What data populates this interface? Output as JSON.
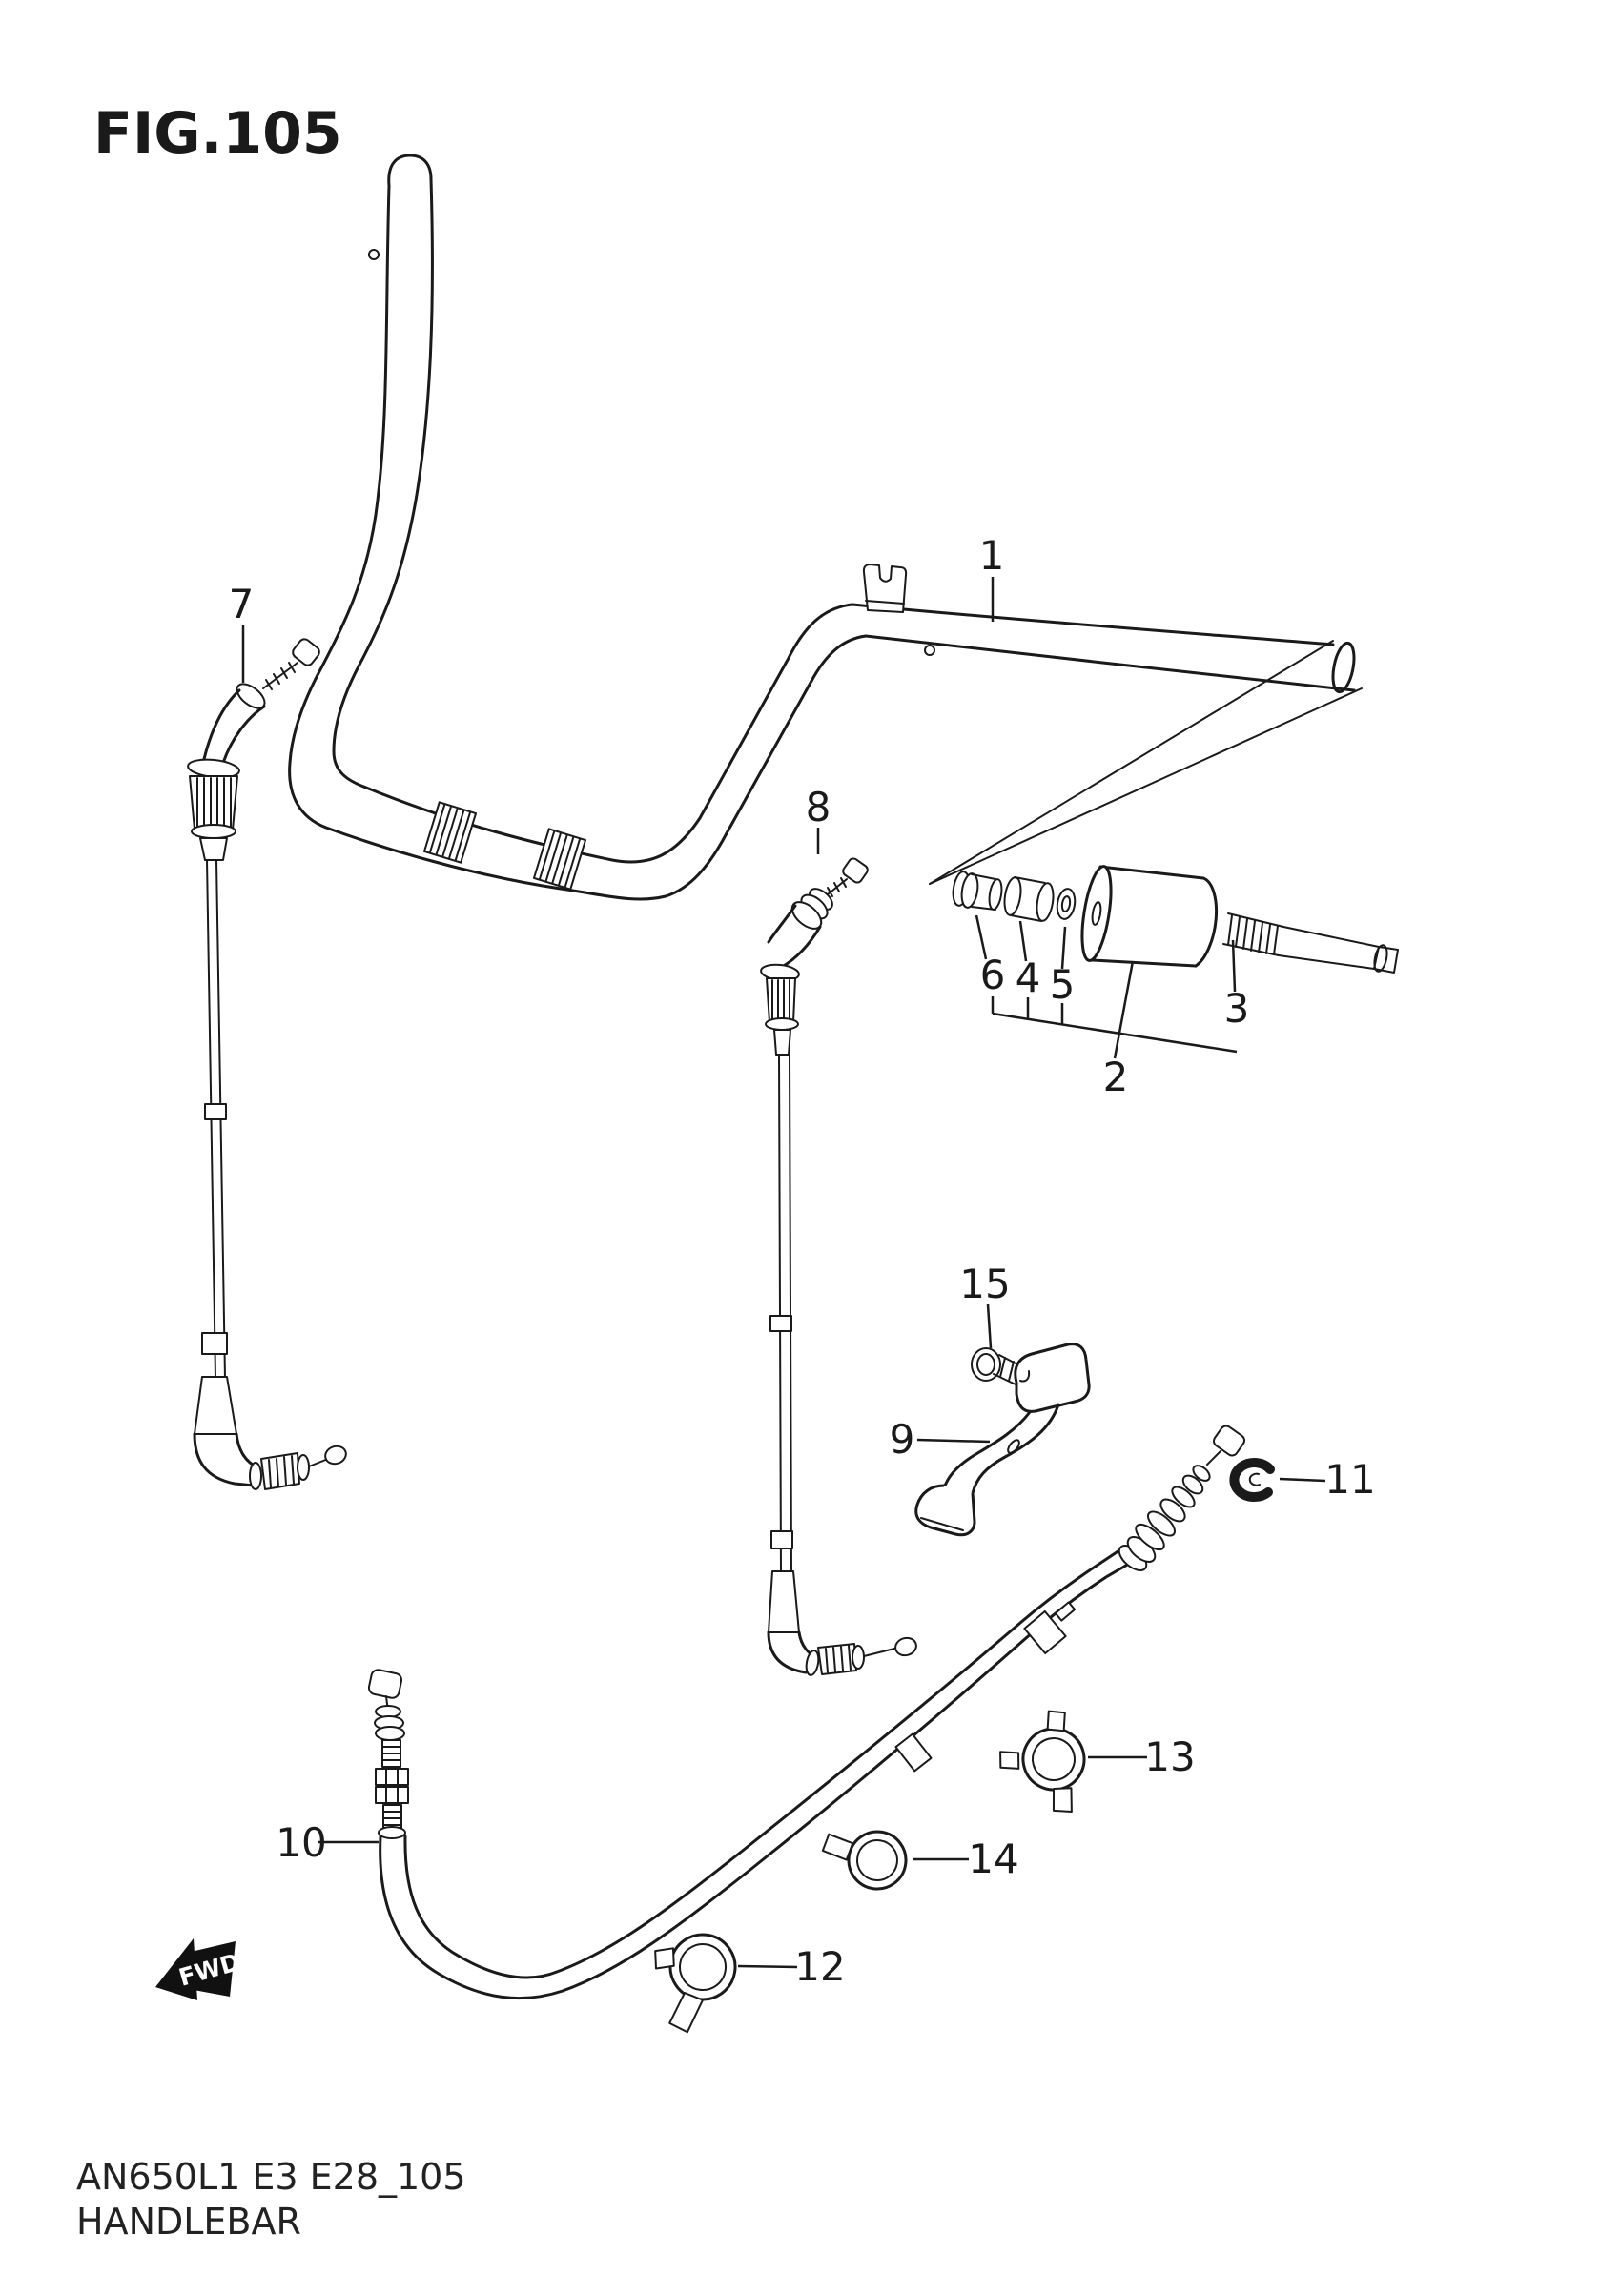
{
  "figure": {
    "title": "FIG.105"
  },
  "callouts": {
    "c1": "1",
    "c2": "2",
    "c3": "3",
    "c4": "4",
    "c5": "5",
    "c6": "6",
    "c7": "7",
    "c8": "8",
    "c9": "9",
    "c10": "10",
    "c11": "11",
    "c12": "12",
    "c13": "13",
    "c14": "14",
    "c15": "15"
  },
  "badge": {
    "label": "FWD"
  },
  "footer": {
    "code": "AN650L1 E3 E28_105",
    "title": "HANDLEBAR"
  },
  "colors": {
    "ink": "#1a1a1a",
    "paper": "#ffffff"
  }
}
